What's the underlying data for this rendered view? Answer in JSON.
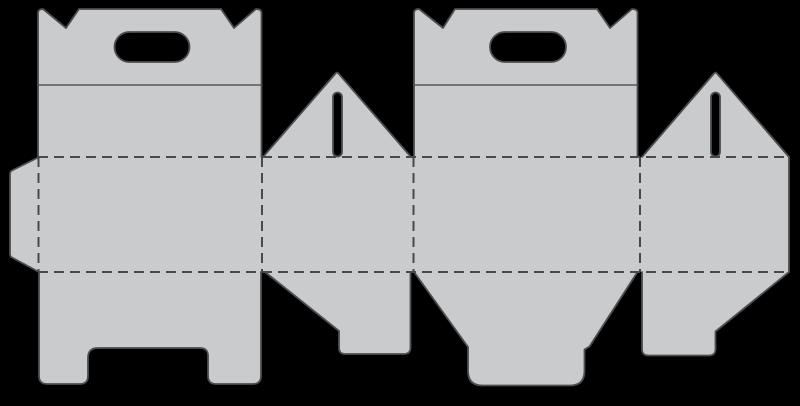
{
  "canvas": {
    "width": 800,
    "height": 406,
    "background": "#000000"
  },
  "palette": {
    "board_fill": "#cacbcd",
    "cut_line": "#4c4e52",
    "fold_line": "#47494d",
    "crease_line": "#55575a",
    "hole_fill": "#000000"
  },
  "stroke": {
    "cut_width": 1.8,
    "fold_width": 2,
    "crease_width": 1.4,
    "fold_dash": "10 6"
  },
  "dieline": {
    "pieces": [
      {
        "name": "body-band-with-glue-tab",
        "path": "M10,171 L38,157 L789,157 L789,272 L38,272 L10,257 Z"
      },
      {
        "name": "front-handle-panel",
        "path": "M38,157 L38,13 Q38,9 43,9 L66,28 L79,9 L221,9 L234,28 L256,9 Q261.5,9 261.5,13 L261.5,157 Z"
      },
      {
        "name": "back-handle-panel",
        "path": "M414,157 L414,13 Q414,9 419,9 L443,28 L455,9 L597,9 L610,28 L632,9 Q637.5,9 637.5,13 L637.5,157 Z"
      },
      {
        "name": "gable-triangle-left",
        "path": "M263,157 L335.5,73.5 Q337,71.6 338.5,73.5 L411,157 Z"
      },
      {
        "name": "gable-triangle-right",
        "path": "M642,157 L714,73.5 Q715.5,71.6 717,73.5 L789,157 Z"
      },
      {
        "name": "bottom-flap-front-legs",
        "path": "M39,272 L39,376 Q39,384 47,384 L80,384 Q88,384 88,376 L88,358 Q88,348 98,348 L200,348 Q208,348 208,356 L208,376 Q208,384 216,384 L253,384 Q261,384 261,376 L261,272 Z"
      },
      {
        "name": "bottom-flap-side-left",
        "path": "M265,272 L339,331 L339,348 Q339,354 345,354 L404,354 Q410.5,354 410.5,347.5 L410.5,272 Z"
      },
      {
        "name": "bottom-flap-back-tuck",
        "path": "M414,272 L468,347 L468,371 Q468,385.5 482.5,385.5 L570,385.5 Q584.5,385.5 584.5,371 L584.5,349.5 L589.5,346.5 L637.5,272 Z"
      },
      {
        "name": "bottom-flap-side-right",
        "path": "M642,272 L642,349 Q642,355.5 648.5,355.5 L709,355.5 Q715.5,355.5 715.5,349 L715.5,331.5 L789,272 Z"
      }
    ],
    "cut_lines": [
      {
        "name": "glue-tab-cut",
        "path": "M38,157.5 L12,170.5 Q10,171.5 10,174 L10,254 Q10,256.5 12,257.5 L38,271.5"
      },
      {
        "name": "front-panel-cut",
        "path": "M38,157 L38,13 Q38,9 43,9 L66,28 L79,9 L221,9 L234,28 L256,9 Q261.5,9 261.5,13 L261.5,157"
      },
      {
        "name": "back-panel-cut",
        "path": "M414,157 L414,13 Q414,9 419,9 L443,28 L455,9 L597,9 L610,28 L632,9 Q637.5,9 637.5,13 L637.5,157"
      },
      {
        "name": "gable-triangle-left-cut",
        "path": "M263,157 L335.5,73.5 Q337,71.6 338.5,73.5 L411,157"
      },
      {
        "name": "gable-triangle-right-cut",
        "path": "M642,157 L714,73.5 Q715.5,71.6 717,73.5 L789,157"
      },
      {
        "name": "band-right-edge-cut",
        "path": "M789,157 L789,272"
      },
      {
        "name": "bottom-flap-front-cut",
        "path": "M39,272 L39,376 Q39,384 47,384 L80,384 Q88,384 88,376 L88,358 Q88,348 98,348 L200,348 Q208,348 208,356 L208,376 Q208,384 216,384 L253,384 Q261,384 261,376 L261,272"
      },
      {
        "name": "bottom-flap-side-left-cut",
        "path": "M265,272 L339,331 L339,348 Q339,354 345,354 L404,354 Q410.5,354 410.5,347.5 L410.5,272"
      },
      {
        "name": "bottom-flap-back-cut",
        "path": "M414,272 L468,347 L468,371 Q468,385.5 482.5,385.5 L570,385.5 Q584.5,385.5 584.5,371 L584.5,349.5 L589.5,346.5 L637.5,272"
      },
      {
        "name": "bottom-flap-side-right-cut",
        "path": "M642,272 L642,349 Q642,355.5 648.5,355.5 L709,355.5 Q715.5,355.5 715.5,349 L715.5,331.5 L789,272"
      }
    ],
    "crease_lines": [
      {
        "name": "front-handle-crease",
        "x1": 38,
        "y1": 85,
        "x2": 261.5,
        "y2": 85
      },
      {
        "name": "back-handle-crease",
        "x1": 414,
        "y1": 85,
        "x2": 637.5,
        "y2": 85
      }
    ],
    "fold_lines": [
      {
        "name": "fold-band-top",
        "x1": 38,
        "y1": 157,
        "x2": 789,
        "y2": 157
      },
      {
        "name": "fold-band-bottom",
        "x1": 38,
        "y1": 272,
        "x2": 789,
        "y2": 272
      },
      {
        "name": "fold-glue-tab",
        "x1": 38.5,
        "y1": 157,
        "x2": 38.5,
        "y2": 272
      },
      {
        "name": "fold-front-to-side",
        "x1": 262,
        "y1": 157,
        "x2": 262,
        "y2": 272
      },
      {
        "name": "fold-side-to-back",
        "x1": 413.5,
        "y1": 157,
        "x2": 413.5,
        "y2": 272
      },
      {
        "name": "fold-back-to-side",
        "x1": 640,
        "y1": 157,
        "x2": 640,
        "y2": 272
      }
    ],
    "holes": [
      {
        "name": "handle-hole-front",
        "x": 114.5,
        "y": 32,
        "w": 75,
        "h": 30,
        "rx": 15
      },
      {
        "name": "handle-hole-back",
        "x": 490,
        "y": 32,
        "w": 76,
        "h": 30,
        "rx": 15
      },
      {
        "name": "lock-slot-left",
        "x": 333,
        "y": 92.5,
        "w": 9,
        "h": 64,
        "rx": 4.5
      },
      {
        "name": "lock-slot-right",
        "x": 711,
        "y": 92.5,
        "w": 9,
        "h": 64,
        "rx": 4.5
      }
    ]
  }
}
